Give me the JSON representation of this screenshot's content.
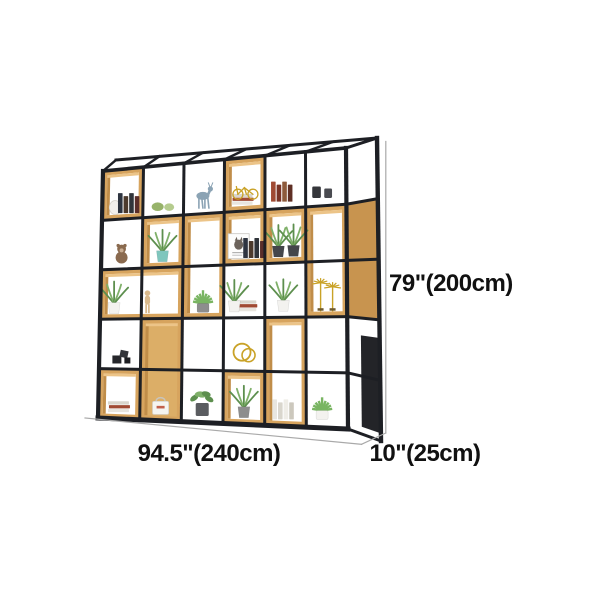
{
  "image": {
    "width": 600,
    "height": 600,
    "background": "#ffffff"
  },
  "dimensions": {
    "height_label": "79\"(200cm)",
    "width_label": "94.5\"(240cm)",
    "depth_label": "10\"(25cm)"
  },
  "scene": {
    "front": {
      "tl": [
        103,
        171
      ],
      "tr": [
        346,
        148
      ],
      "bl": [
        98,
        418
      ],
      "br": [
        348,
        429
      ]
    },
    "back": {
      "tl": [
        116,
        160
      ],
      "tr": [
        377,
        138
      ],
      "br": [
        381,
        441
      ]
    },
    "cols": 6,
    "rows": 5,
    "colors": {
      "frame": "#1d1f24",
      "wood": "#d7a45e",
      "woodEdge": "#97713a",
      "woodLight": "#ecc488",
      "woodDark": "#c08d49",
      "woodIn": "#dcae67",
      "woodSide": "#c8944f",
      "white": "#ffffff",
      "dim": "#a9a9a9",
      "ink": "#111111"
    },
    "palette": {
      "green": "#5d8f4e",
      "green2": "#7fb069",
      "greenDark": "#3f6d35",
      "potWhite": "#f3f2ef",
      "potGray": "#8d8d8d",
      "potDark": "#44464b",
      "potTeal": "#7fc6bd",
      "gold": "#c9a227",
      "woodItem": "#d9b98c",
      "dark": "#2b2c30",
      "bookDark": [
        "#2e3440",
        "#4c3a2d",
        "#30343a",
        "#5a2e2a"
      ],
      "bookWarm": [
        "#a04a33",
        "#7a3426",
        "#8d5a3b",
        "#5f2f24"
      ],
      "bookLight": [
        "#e8e6e0",
        "#d9d6cd",
        "#efede7",
        "#ccc8bd"
      ]
    },
    "wood_boxes": [
      {
        "c": 0,
        "r": 0,
        "cs": 1,
        "rs": 1,
        "i": "white"
      },
      {
        "c": 3,
        "r": 0,
        "cs": 1,
        "rs": 1,
        "i": "white"
      },
      {
        "c": 1,
        "r": 1,
        "cs": 1,
        "rs": 1,
        "i": "white"
      },
      {
        "c": 3,
        "r": 1,
        "cs": 1,
        "rs": 1,
        "i": "white"
      },
      {
        "c": 4,
        "r": 1,
        "cs": 1,
        "rs": 1,
        "i": "white"
      },
      {
        "c": 2,
        "r": 1,
        "cs": 1,
        "rs": 2,
        "i": "white"
      },
      {
        "c": 5,
        "r": 1,
        "cs": 1,
        "rs": 2,
        "i": "white"
      },
      {
        "c": 0,
        "r": 2,
        "cs": 2,
        "rs": 1,
        "i": "white"
      },
      {
        "c": 1,
        "r": 3,
        "cs": 1,
        "rs": 2,
        "i": "wood"
      },
      {
        "c": 4,
        "r": 3,
        "cs": 1,
        "rs": 2,
        "i": "white"
      },
      {
        "c": 0,
        "r": 4,
        "cs": 1,
        "rs": 1,
        "i": "white"
      },
      {
        "c": 3,
        "r": 4,
        "cs": 1,
        "rs": 1,
        "i": "white"
      }
    ],
    "items": [
      {
        "type": "vase",
        "c": 0.32,
        "f": 0.178
      },
      {
        "type": "books",
        "c": 0.66,
        "f": 0.178,
        "v": "bookDark"
      },
      {
        "type": "figurines",
        "c": 1.5,
        "f": 0.178
      },
      {
        "type": "deer",
        "c": 2.5,
        "f": 0.178
      },
      {
        "type": "booksFlat",
        "c": 3.45,
        "f": 0.178
      },
      {
        "type": "bicycle",
        "c": 3.52,
        "f": 0.158
      },
      {
        "type": "books",
        "c": 4.42,
        "f": 0.175,
        "v": "bookWarm"
      },
      {
        "type": "cups",
        "c": 5.42,
        "f": 0.172
      },
      {
        "type": "bear",
        "c": 0.5,
        "f": 0.378
      },
      {
        "type": "plant",
        "c": 1.5,
        "f": 0.378,
        "v": "potTeal"
      },
      {
        "type": "poster",
        "c": 3.36,
        "f": 0.378
      },
      {
        "type": "books",
        "c": 3.74,
        "f": 0.378,
        "v": "bookDark"
      },
      {
        "type": "plant",
        "c": 4.33,
        "f": 0.378,
        "v": "potDark"
      },
      {
        "type": "plant",
        "c": 4.7,
        "f": 0.378,
        "v": "potDark"
      },
      {
        "type": "plant",
        "c": 0.34,
        "f": 0.578,
        "v": "potWhite"
      },
      {
        "type": "mannequin",
        "c": 1.15,
        "f": 0.578
      },
      {
        "type": "succulent",
        "c": 2.5,
        "f": 0.578,
        "v": "potGray"
      },
      {
        "type": "booksFlat",
        "c": 3.55,
        "f": 0.578
      },
      {
        "type": "plant",
        "c": 3.26,
        "f": 0.578,
        "v": "potWhite"
      },
      {
        "type": "plant",
        "c": 4.45,
        "f": 0.578,
        "v": "potWhite"
      },
      {
        "type": "palms",
        "c": 5.5,
        "f": 0.578
      },
      {
        "type": "cubes",
        "c": 0.55,
        "f": 0.778
      },
      {
        "type": "rings",
        "c": 3.5,
        "f": 0.778
      },
      {
        "type": "booksFlat",
        "c": 0.5,
        "f": 0.975
      },
      {
        "type": "bag",
        "c": 1.5,
        "f": 0.975
      },
      {
        "type": "hangplant",
        "c": 2.5,
        "f": 0.975
      },
      {
        "type": "plant",
        "c": 3.5,
        "f": 0.975,
        "v": "potGray"
      },
      {
        "type": "books",
        "c": 4.45,
        "f": 0.975,
        "v": "bookLight"
      },
      {
        "type": "succulent",
        "c": 5.38,
        "f": 0.97,
        "v": "potWhite"
      }
    ]
  }
}
